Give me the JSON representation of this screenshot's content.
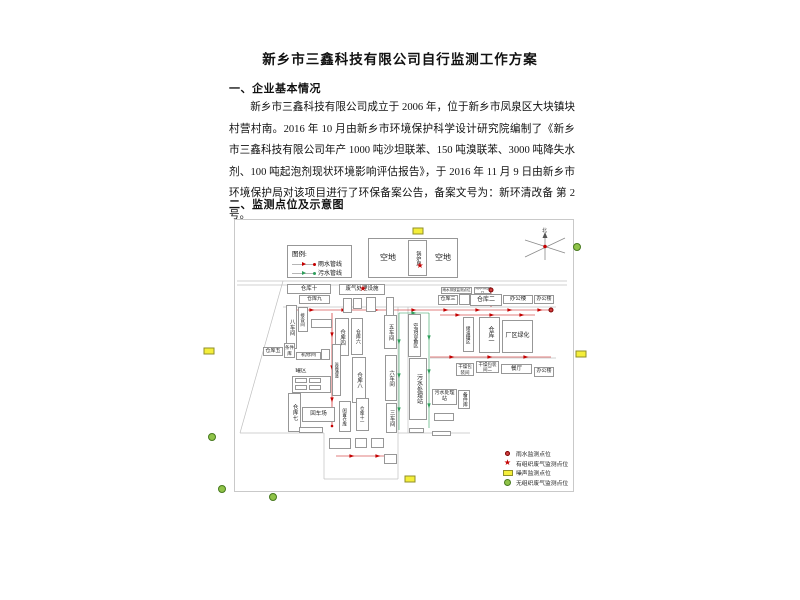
{
  "document": {
    "title": "新乡市三鑫科技有限公司自行监测工作方案",
    "section1_heading": "一、企业基本情况",
    "paragraph": "新乡市三鑫科技有限公司成立于 2006 年，位于新乡市凤泉区大块镇块村营村南。2016 年 10 月由新乡市环境保护科学设计研究院编制了《新乡市三鑫科技有限公司年产 1000 吨沙坦联苯、150 吨溴联苯、3000 吨降失水剂、100 吨起泡剂现状环境影响评估报告》，于 2016 年 11 月 9 日由新乡市环境保护局对该项目进行了环保备案公告，备案文号为：新环清改备 第 2 号。",
    "section2_heading": "二、监测点位及示意图"
  },
  "diagram": {
    "compass_label": "北",
    "colors": {
      "rain_pipe": "#c40000",
      "sewage_pipe": "#2e9e5b",
      "noise_point": "#f4ee3a",
      "gas_point": "#8fc348",
      "structure_line": "#c0c0c0"
    },
    "legend_top": {
      "title": "图例:",
      "items": [
        {
          "label": "雨水管线",
          "color": "#c40000"
        },
        {
          "label": "污水管线",
          "color": "#2e9e5b"
        }
      ]
    },
    "legend_bottom": [
      {
        "marker": "dot",
        "label": "雨水监测点位"
      },
      {
        "marker": "star",
        "label": "有组织废气监测点位"
      },
      {
        "marker": "rect",
        "label": "噪声监测点位"
      },
      {
        "marker": "circle",
        "label": "无组织废气监测点位"
      }
    ],
    "buildings": [
      {
        "id": "kongdi-outer",
        "label": "",
        "x": 368,
        "y": 238,
        "w": 90,
        "h": 40
      },
      {
        "id": "kongdi-left",
        "label": "空地",
        "x": 371,
        "y": 251,
        "w": 34,
        "h": 13,
        "plain": true,
        "fs": 8
      },
      {
        "id": "kongdi-right",
        "label": "空地",
        "x": 429,
        "y": 251,
        "w": 28,
        "h": 13,
        "plain": true,
        "fs": 8
      },
      {
        "id": "guolufang",
        "label": "锅炉房",
        "x": 408,
        "y": 240,
        "w": 19,
        "h": 36,
        "v": true,
        "fs": 5
      },
      {
        "id": "cangku-10",
        "label": "仓库十",
        "x": 287,
        "y": 284,
        "w": 44,
        "h": 10,
        "fs": 5.5
      },
      {
        "id": "cangku-9",
        "label": "仓库九",
        "x": 299,
        "y": 295,
        "w": 31,
        "h": 9,
        "fs": 5
      },
      {
        "id": "feiqi-chuli",
        "label": "废气处理设施",
        "x": 339,
        "y": 284,
        "w": 46,
        "h": 11,
        "fs": 5.5
      },
      {
        "id": "bachejian",
        "label": "八车间",
        "x": 286,
        "y": 305,
        "w": 11,
        "h": 44,
        "v": true,
        "fs": 5.5
      },
      {
        "id": "jiehejian",
        "label": "接合间",
        "x": 298,
        "y": 307,
        "w": 10,
        "h": 25,
        "v": true,
        "fs": 4.5
      },
      {
        "id": "box-a",
        "label": "",
        "x": 311,
        "y": 319,
        "w": 21,
        "h": 9
      },
      {
        "id": "box-b",
        "label": "",
        "x": 343,
        "y": 298,
        "w": 9,
        "h": 15
      },
      {
        "id": "box-c",
        "label": "",
        "x": 353,
        "y": 298,
        "w": 9,
        "h": 11
      },
      {
        "id": "box-d",
        "label": "",
        "x": 366,
        "y": 297,
        "w": 10,
        "h": 15
      },
      {
        "id": "box-e",
        "label": "",
        "x": 386,
        "y": 297,
        "w": 8,
        "h": 19
      },
      {
        "id": "cangku-4",
        "label": "仓库四",
        "x": 335,
        "y": 318,
        "w": 14,
        "h": 38,
        "v": true,
        "fs": 5.5
      },
      {
        "id": "cangku-6",
        "label": "仓库六",
        "x": 351,
        "y": 318,
        "w": 12,
        "h": 37,
        "v": true,
        "fs": 5
      },
      {
        "id": "wuchejian",
        "label": "五车间",
        "x": 384,
        "y": 315,
        "w": 13,
        "h": 34,
        "v": true,
        "fs": 5.5
      },
      {
        "id": "kongtiao-shebei",
        "label": "空调设备区",
        "x": 408,
        "y": 314,
        "w": 13,
        "h": 43,
        "v": true,
        "fs": 5
      },
      {
        "id": "cangku-3",
        "label": "仓库三",
        "x": 438,
        "y": 295,
        "w": 20,
        "h": 10,
        "fs": 5
      },
      {
        "id": "box-f",
        "label": "",
        "x": 459,
        "y": 294,
        "w": 11,
        "h": 11
      },
      {
        "id": "cangku-2",
        "label": "仓库二",
        "x": 470,
        "y": 294,
        "w": 32,
        "h": 12,
        "fs": 6
      },
      {
        "id": "bangonglou-1",
        "label": "办公楼",
        "x": 503,
        "y": 295,
        "w": 30,
        "h": 9,
        "fs": 5.5
      },
      {
        "id": "bangonglou-2",
        "label": "办公楼",
        "x": 534,
        "y": 295,
        "w": 20,
        "h": 9,
        "fs": 5
      },
      {
        "id": "chuyou-guanqu",
        "label": "储油罐区",
        "x": 463,
        "y": 317,
        "w": 11,
        "h": 35,
        "v": true,
        "fs": 4.5
      },
      {
        "id": "cangku-1",
        "label": "仓库一",
        "x": 479,
        "y": 317,
        "w": 21,
        "h": 36,
        "v": true,
        "fs": 6
      },
      {
        "id": "changqu-lvhua",
        "label": "厂区绿化",
        "x": 502,
        "y": 320,
        "w": 31,
        "h": 33,
        "fs": 6
      },
      {
        "id": "tiaojianku",
        "label": "条件库",
        "x": 284,
        "y": 343,
        "w": 11,
        "h": 15,
        "fs": 4.5
      },
      {
        "id": "cangku-5",
        "label": "仓库五",
        "x": 263,
        "y": 347,
        "w": 20,
        "h": 9,
        "fs": 5
      },
      {
        "id": "jixiujian",
        "label": "机修间",
        "x": 296,
        "y": 352,
        "w": 25,
        "h": 8,
        "fs": 5
      },
      {
        "id": "box-g",
        "label": "",
        "x": 321,
        "y": 349,
        "w": 9,
        "h": 11
      },
      {
        "id": "guanqu-label",
        "label": "罐区",
        "x": 292,
        "y": 368,
        "w": 18,
        "h": 7,
        "plain": true,
        "fs": 5.5
      },
      {
        "id": "guanqu-box",
        "label": "",
        "x": 292,
        "y": 376,
        "w": 39,
        "h": 17
      },
      {
        "id": "guanqu-t1",
        "label": "",
        "x": 295,
        "y": 378,
        "w": 12,
        "h": 5
      },
      {
        "id": "guanqu-t2",
        "label": "",
        "x": 295,
        "y": 385,
        "w": 12,
        "h": 5
      },
      {
        "id": "guanqu-t3",
        "label": "",
        "x": 309,
        "y": 378,
        "w": 12,
        "h": 5
      },
      {
        "id": "guanqu-t4",
        "label": "",
        "x": 309,
        "y": 385,
        "w": 12,
        "h": 5
      },
      {
        "id": "yunshu-tongdao",
        "label": "运输通道",
        "x": 332,
        "y": 344,
        "w": 9,
        "h": 52,
        "v": true,
        "fs": 4
      },
      {
        "id": "cangku-8",
        "label": "仓库八",
        "x": 352,
        "y": 357,
        "w": 14,
        "h": 46,
        "v": true,
        "fs": 5.5
      },
      {
        "id": "liuchejian",
        "label": "六车间",
        "x": 385,
        "y": 355,
        "w": 12,
        "h": 46,
        "v": true,
        "fs": 5.5
      },
      {
        "id": "cangku-7",
        "label": "仓库七",
        "x": 288,
        "y": 393,
        "w": 13,
        "h": 39,
        "v": true,
        "fs": 5.5
      },
      {
        "id": "huichechang",
        "label": "回车场",
        "x": 302,
        "y": 407,
        "w": 33,
        "h": 15,
        "fs": 5.5
      },
      {
        "id": "box-h",
        "label": "",
        "x": 299,
        "y": 427,
        "w": 24,
        "h": 6
      },
      {
        "id": "xianzhi-cangku",
        "label": "闲置仓库",
        "x": 339,
        "y": 401,
        "w": 12,
        "h": 31,
        "v": true,
        "fs": 4.5
      },
      {
        "id": "cangku-11",
        "label": "仓库十一",
        "x": 356,
        "y": 398,
        "w": 13,
        "h": 33,
        "v": true,
        "fs": 4.5
      },
      {
        "id": "sanchejian",
        "label": "三车间",
        "x": 386,
        "y": 403,
        "w": 11,
        "h": 30,
        "v": true,
        "fs": 5.5
      },
      {
        "id": "wushui-zhan-v",
        "label": "污水处理站",
        "x": 409,
        "y": 358,
        "w": 18,
        "h": 62,
        "v": true,
        "fs": 6
      },
      {
        "id": "ganzao-1",
        "label": "干燥包装间",
        "x": 456,
        "y": 363,
        "w": 18,
        "h": 13,
        "fs": 4.5
      },
      {
        "id": "ganzao-2",
        "label": "干燥包装间二",
        "x": 476,
        "y": 361,
        "w": 23,
        "h": 12,
        "fs": 4.5
      },
      {
        "id": "canting",
        "label": "餐厅",
        "x": 501,
        "y": 364,
        "w": 31,
        "h": 10,
        "fs": 5.5
      },
      {
        "id": "bangonglou-3",
        "label": "办公楼",
        "x": 534,
        "y": 367,
        "w": 20,
        "h": 10,
        "fs": 5
      },
      {
        "id": "wushui-zhan-box",
        "label": "污水处理站",
        "x": 432,
        "y": 389,
        "w": 25,
        "h": 16,
        "fs": 5
      },
      {
        "id": "beijianku",
        "label": "备件库",
        "x": 458,
        "y": 390,
        "w": 12,
        "h": 19,
        "v": true,
        "fs": 5
      },
      {
        "id": "box-i",
        "label": "",
        "x": 434,
        "y": 413,
        "w": 20,
        "h": 8
      },
      {
        "id": "box-j",
        "label": "",
        "x": 409,
        "y": 428,
        "w": 15,
        "h": 5
      },
      {
        "id": "box-k",
        "label": "",
        "x": 432,
        "y": 431,
        "w": 19,
        "h": 5
      },
      {
        "id": "box-l",
        "label": "",
        "x": 329,
        "y": 438,
        "w": 22,
        "h": 11
      },
      {
        "id": "box-m",
        "label": "",
        "x": 355,
        "y": 438,
        "w": 12,
        "h": 10
      },
      {
        "id": "box-n",
        "label": "",
        "x": 371,
        "y": 438,
        "w": 13,
        "h": 10
      },
      {
        "id": "box-o",
        "label": "",
        "x": 384,
        "y": 454,
        "w": 13,
        "h": 10
      },
      {
        "id": "outfall-label-1",
        "label": "雨水排放监测点位",
        "x": 441,
        "y": 287,
        "w": 31,
        "h": 7,
        "fs": 3.5
      },
      {
        "id": "outfall-label-2",
        "label": "雨水排放口",
        "x": 474,
        "y": 287,
        "w": 17,
        "h": 7,
        "fs": 3.5
      }
    ],
    "markers": {
      "noise_points": [
        [
          418,
          231
        ],
        [
          209,
          351
        ],
        [
          581,
          354
        ],
        [
          410,
          479
        ]
      ],
      "gas_points": [
        [
          577,
          247
        ],
        [
          212,
          437
        ],
        [
          222,
          489
        ],
        [
          273,
          497
        ]
      ],
      "stars": [
        [
          420,
          266
        ],
        [
          363,
          289
        ]
      ],
      "monitor_dots": [
        [
          491,
          290
        ],
        [
          551,
          310
        ]
      ]
    },
    "lines": [
      [
        237,
        281,
        567,
        281
      ],
      [
        237,
        285,
        567,
        285
      ],
      [
        283,
        307,
        556,
        307
      ],
      [
        398,
        307,
        398,
        433
      ],
      [
        408,
        307,
        408,
        433
      ],
      [
        283,
        281,
        240,
        433
      ],
      [
        240,
        433,
        324,
        433
      ],
      [
        324,
        433,
        324,
        479
      ],
      [
        324,
        479,
        398,
        479
      ],
      [
        398,
        479,
        398,
        433
      ],
      [
        398,
        433,
        470,
        433
      ],
      [
        430,
        358,
        556,
        358
      ]
    ],
    "pipes": {
      "rain": [
        [
          293,
          310,
          550,
          310
        ],
        [
          491,
          293,
          491,
          307
        ],
        [
          332,
          313,
          332,
          426
        ],
        [
          440,
          315,
          535,
          315
        ],
        [
          430,
          357,
          551,
          357
        ],
        [
          336,
          456,
          390,
          456
        ]
      ],
      "sewage": [
        [
          399,
          313,
          399,
          430
        ],
        [
          429,
          313,
          429,
          428
        ],
        [
          399,
          313,
          429,
          313
        ]
      ]
    },
    "arrows": {
      "rain": [
        [
          312,
          310,
          0
        ],
        [
          344,
          310,
          0
        ],
        [
          376,
          310,
          0
        ],
        [
          414,
          310,
          0
        ],
        [
          446,
          310,
          0
        ],
        [
          478,
          310,
          0
        ],
        [
          510,
          310,
          0
        ],
        [
          540,
          310,
          0
        ],
        [
          332,
          335,
          90
        ],
        [
          332,
          368,
          90
        ],
        [
          332,
          400,
          90
        ],
        [
          458,
          315,
          0
        ],
        [
          492,
          315,
          0
        ],
        [
          522,
          315,
          0
        ],
        [
          452,
          357,
          0
        ],
        [
          490,
          357,
          0
        ],
        [
          526,
          357,
          0
        ],
        [
          352,
          456,
          0
        ],
        [
          378,
          456,
          0
        ],
        [
          491,
          298,
          270
        ]
      ],
      "sewage": [
        [
          399,
          342,
          90
        ],
        [
          399,
          376,
          90
        ],
        [
          399,
          410,
          90
        ],
        [
          429,
          338,
          90
        ],
        [
          429,
          372,
          90
        ],
        [
          429,
          406,
          90
        ],
        [
          414,
          313,
          0
        ]
      ],
      "rain_dots": [
        [
          550,
          310
        ],
        [
          332,
          426
        ],
        [
          293,
          310
        ]
      ]
    }
  }
}
